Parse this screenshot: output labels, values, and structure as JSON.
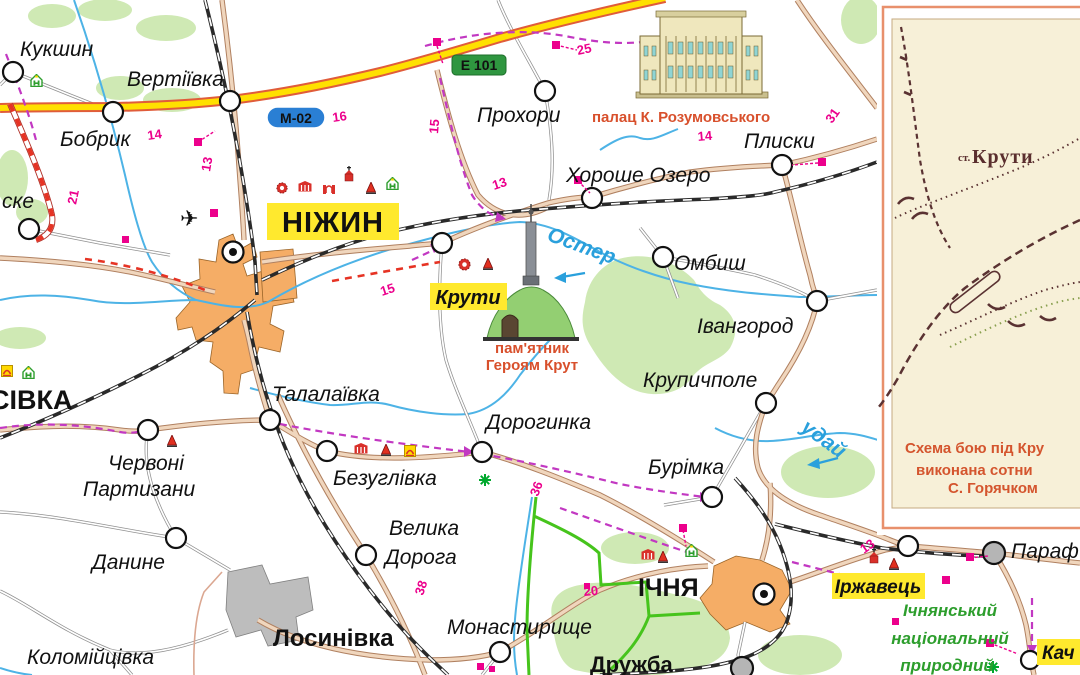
{
  "colors": {
    "highway_yellow": "#ffe000",
    "highway_casing": "#e05c3a",
    "road_beige": "#f0d6bd",
    "road_casing": "#b08060",
    "water_blue": "#4db3e6",
    "river_label_blue": "#2aa0dc",
    "forest_green": "#cfe9b4",
    "urban_orange": "#f5ad66",
    "urban_gray": "#bdbdbd",
    "label_highlight_yellow": "#ffe92e",
    "distance_magenta": "#ec008c",
    "route_violet": "#c238c2",
    "construction_red": "#e63324",
    "park_green": "#46c41c",
    "landmark_red": "#d8502c",
    "inset_cream": "#f7f0d8",
    "inset_frame_salmon": "#e8906c",
    "inset_ink_brown": "#5a3232",
    "sign_green": "#2f9640",
    "sign_blue": "#2a7fd4"
  },
  "icons": {
    "airport": "✈",
    "star": "✳",
    "hotel": "hotel-house-H",
    "museum": "museum-building",
    "church": "church-cross",
    "monument": "red-obelisk",
    "fortress": "red-ring",
    "gate": "red-gate",
    "sight_box": "yellow-arch-box"
  },
  "road_signs": {
    "e101": "Е 101",
    "m02": "М-02"
  },
  "rivers": {
    "oster": "Остер",
    "uday": "удай"
  },
  "settlements": {
    "kukshyn": "Кукшин",
    "vertiivka": "Вертіївка",
    "bobryk": "Бобрик",
    "ske_partial": "ске",
    "sivka_partial": "СІВКА",
    "nizhyn": "НІЖИН",
    "prokhory": "Прохори",
    "khoroshe_ozero": "Хороше Озеро",
    "plysky": "Плиски",
    "ombysh": "Омбиш",
    "ivanhorod": "Івангород",
    "krupychpole": "Крупичполе",
    "kruty": "Крути",
    "talalaivka": "Талалаївка",
    "chervoni_line1": "Червоні",
    "chervoni_line2": "Партизани",
    "bezuhlivka": "Безуглівка",
    "dorohynka": "Дорогинка",
    "burimka": "Бурімка",
    "danyne": "Данине",
    "velyka_line1": "Велика",
    "velyka_line2": "Дорога",
    "monastyryshche": "Монастирище",
    "kolomiitsivka": "Коломійцівка",
    "losynivka": "Лосинівка",
    "ichnia": "ІЧНЯ",
    "druzhba": "Дружба",
    "irzhavets": "Іржавець",
    "parafiivka_partial": "Параф",
    "kachanivka_partial": "Кач"
  },
  "park": {
    "line1": "Ічнянський",
    "line2": "національний",
    "line3": "природний"
  },
  "landmarks": {
    "palace_caption": "палац К. Розумовського",
    "monument_line1": "пам'ятник",
    "monument_line2": "Героям Крут"
  },
  "inset": {
    "station_prefix": "ст.",
    "station_name": "Крути",
    "caption_line1": "Схема бою під Кру",
    "caption_line2": "виконана сотни",
    "caption_line3": "С. Горячком"
  },
  "distances": {
    "d14a": "14",
    "d16": "16",
    "d21": "21",
    "d13a": "13",
    "d25": "25",
    "d15a": "15",
    "d13b": "13",
    "d14b": "14",
    "d31": "31",
    "d15b": "15",
    "d36": "36",
    "d38": "38",
    "d20": "20",
    "d13c": "13"
  }
}
